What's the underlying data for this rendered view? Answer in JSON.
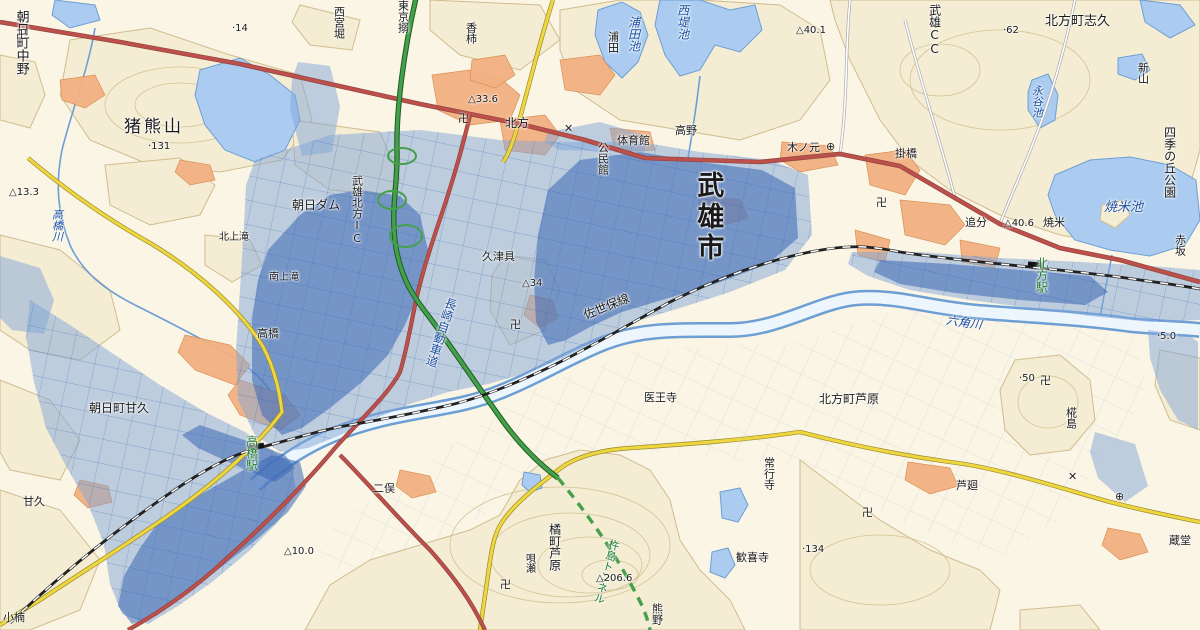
{
  "map": {
    "colors": {
      "base": "#faf5e4",
      "hill": "#f4edd3",
      "contour": "#d2bc8f",
      "water": "#abccf0",
      "water_edge": "#6d9fd4",
      "river_fill": "#eef6fd",
      "flood_light": "rgba(128,165,216,0.50)",
      "flood_dark": "rgba(58,104,180,0.55)",
      "flood_grid": "#2f62b5",
      "field_grid": "#c3cfdf",
      "road_red": "#bd504a",
      "road_red_edge": "#8f4440",
      "road_yellow": "#eed63e",
      "road_yellow_edge": "#9a8a30",
      "expressway": "#44a04a",
      "expressway_edge": "#1f5c24",
      "railway": "#222222",
      "builtup": "#f2b183",
      "builtup_edge": "#d98c4f",
      "label_black": "#1a1a1a",
      "label_water": "#1c4fa0",
      "label_station": "#1f7a33"
    },
    "labels": [
      {
        "text": "朝日町中野",
        "x": 14,
        "y": 10,
        "dir": "v",
        "size": 13,
        "color": "black"
      },
      {
        "text": "猪熊山",
        "x": 124,
        "y": 119,
        "dir": "h",
        "size": 17,
        "color": "black",
        "spacing": 3
      },
      {
        "text": "·131",
        "x": 148,
        "y": 142,
        "dir": "h",
        "size": 10,
        "color": "black"
      },
      {
        "text": "·14",
        "x": 232,
        "y": 24,
        "dir": "h",
        "size": 10,
        "color": "black"
      },
      {
        "text": "西宮堀",
        "x": 333,
        "y": 6,
        "dir": "v",
        "size": 11,
        "color": "black"
      },
      {
        "text": "東京搦",
        "x": 397,
        "y": 0,
        "dir": "v",
        "size": 11,
        "color": "black"
      },
      {
        "text": "香柿",
        "x": 465,
        "y": 22,
        "dir": "v",
        "size": 11,
        "color": "black"
      },
      {
        "text": "浦田",
        "x": 607,
        "y": 31,
        "dir": "v",
        "size": 11,
        "color": "black"
      },
      {
        "text": "浦田池",
        "x": 627,
        "y": 16,
        "dir": "v",
        "size": 12,
        "color": "water",
        "italic": true
      },
      {
        "text": "西堤池",
        "x": 676,
        "y": 4,
        "dir": "v",
        "size": 12,
        "color": "water",
        "italic": true
      },
      {
        "text": "武雄CC",
        "x": 928,
        "y": 4,
        "dir": "v",
        "size": 12,
        "color": "black"
      },
      {
        "text": "△40.1",
        "x": 796,
        "y": 26,
        "dir": "h",
        "size": 10,
        "color": "black"
      },
      {
        "text": "·62",
        "x": 1003,
        "y": 26,
        "dir": "h",
        "size": 10,
        "color": "black"
      },
      {
        "text": "北方町志久",
        "x": 1045,
        "y": 15,
        "dir": "h",
        "size": 13,
        "color": "black"
      },
      {
        "text": "新山",
        "x": 1137,
        "y": 62,
        "dir": "v",
        "size": 11,
        "color": "black"
      },
      {
        "text": "永谷池",
        "x": 1031,
        "y": 85,
        "dir": "v",
        "size": 11,
        "color": "water",
        "italic": true
      },
      {
        "text": "四季の丘公園",
        "x": 1163,
        "y": 126,
        "dir": "v",
        "size": 12,
        "color": "black"
      },
      {
        "text": "焼米池",
        "x": 1104,
        "y": 201,
        "dir": "h",
        "size": 13,
        "color": "water",
        "italic": true
      },
      {
        "text": "焼米",
        "x": 1043,
        "y": 217,
        "dir": "h",
        "size": 11,
        "color": "black"
      },
      {
        "text": "△40.6",
        "x": 1004,
        "y": 219,
        "dir": "h",
        "size": 10,
        "color": "black"
      },
      {
        "text": "追分",
        "x": 965,
        "y": 217,
        "dir": "h",
        "size": 11,
        "color": "black"
      },
      {
        "text": "掛橋",
        "x": 895,
        "y": 148,
        "dir": "h",
        "size": 11,
        "color": "black"
      },
      {
        "text": "赤坂",
        "x": 1174,
        "y": 234,
        "dir": "v",
        "size": 11,
        "color": "black"
      },
      {
        "text": "体育館",
        "x": 617,
        "y": 135,
        "dir": "h",
        "size": 11,
        "color": "black"
      },
      {
        "text": "公民館",
        "x": 597,
        "y": 142,
        "dir": "v",
        "size": 11,
        "color": "black"
      },
      {
        "text": "高野",
        "x": 675,
        "y": 125,
        "dir": "h",
        "size": 11,
        "color": "black"
      },
      {
        "text": "木ノ元",
        "x": 787,
        "y": 142,
        "dir": "h",
        "size": 11,
        "color": "black"
      },
      {
        "text": "北方",
        "x": 505,
        "y": 117,
        "dir": "h",
        "size": 12,
        "color": "black"
      },
      {
        "text": "△33.6",
        "x": 468,
        "y": 95,
        "dir": "h",
        "size": 10,
        "color": "black"
      },
      {
        "text": "武雄市",
        "x": 693,
        "y": 171,
        "dir": "v",
        "size": 27,
        "color": "black",
        "bold": true,
        "spacing": 4
      },
      {
        "text": "朝日ダム",
        "x": 292,
        "y": 199,
        "dir": "h",
        "size": 12,
        "color": "black"
      },
      {
        "text": "武雄北方IC",
        "x": 351,
        "y": 175,
        "dir": "v",
        "size": 11,
        "color": "black"
      },
      {
        "text": "高橋川",
        "x": 51,
        "y": 209,
        "dir": "v",
        "size": 11,
        "color": "water",
        "italic": true
      },
      {
        "text": "△13.3",
        "x": 9,
        "y": 188,
        "dir": "h",
        "size": 10,
        "color": "black"
      },
      {
        "text": "北上滝",
        "x": 219,
        "y": 233,
        "dir": "h",
        "size": 10,
        "color": "black"
      },
      {
        "text": "南上滝",
        "x": 269,
        "y": 273,
        "dir": "h",
        "size": 10,
        "color": "black"
      },
      {
        "text": "久津具",
        "x": 482,
        "y": 251,
        "dir": "h",
        "size": 11,
        "color": "black"
      },
      {
        "text": "△34",
        "x": 522,
        "y": 279,
        "dir": "h",
        "size": 10,
        "color": "black"
      },
      {
        "text": "長崎自動車道",
        "x": 446,
        "y": 296,
        "dir": "v",
        "size": 12,
        "color": "water",
        "rotate": 18
      },
      {
        "text": "佐世保線",
        "x": 582,
        "y": 310,
        "dir": "h",
        "size": 12,
        "color": "black",
        "rotate": -22
      },
      {
        "text": "六角川",
        "x": 947,
        "y": 314,
        "dir": "h",
        "size": 12,
        "color": "water",
        "italic": true,
        "rotate": 8
      },
      {
        "text": "北方駅",
        "x": 1035,
        "y": 257,
        "dir": "v",
        "size": 12,
        "color": "station"
      },
      {
        "text": "·50",
        "x": 1019,
        "y": 374,
        "dir": "h",
        "size": 10,
        "color": "black"
      },
      {
        "text": "·5.0",
        "x": 1157,
        "y": 332,
        "dir": "h",
        "size": 10,
        "color": "black"
      },
      {
        "text": "北方町芦原",
        "x": 819,
        "y": 393,
        "dir": "h",
        "size": 12,
        "color": "black"
      },
      {
        "text": "椛島",
        "x": 1065,
        "y": 407,
        "dir": "v",
        "size": 11,
        "color": "black"
      },
      {
        "text": "医王寺",
        "x": 644,
        "y": 392,
        "dir": "h",
        "size": 11,
        "color": "black"
      },
      {
        "text": "朝日町甘久",
        "x": 89,
        "y": 402,
        "dir": "h",
        "size": 12,
        "color": "black"
      },
      {
        "text": "甘久",
        "x": 23,
        "y": 496,
        "dir": "h",
        "size": 11,
        "color": "black"
      },
      {
        "text": "高橋",
        "x": 257,
        "y": 328,
        "dir": "h",
        "size": 11,
        "color": "black"
      },
      {
        "text": "高橋駅",
        "x": 245,
        "y": 435,
        "dir": "v",
        "size": 12,
        "color": "station"
      },
      {
        "text": "二俣",
        "x": 373,
        "y": 483,
        "dir": "h",
        "size": 11,
        "color": "black"
      },
      {
        "text": "△10.0",
        "x": 284,
        "y": 547,
        "dir": "h",
        "size": 10,
        "color": "black"
      },
      {
        "text": "常行寺",
        "x": 763,
        "y": 457,
        "dir": "v",
        "size": 11,
        "color": "black"
      },
      {
        "text": "歓喜寺",
        "x": 736,
        "y": 552,
        "dir": "h",
        "size": 11,
        "color": "black"
      },
      {
        "text": "唄瀬",
        "x": 523,
        "y": 553,
        "dir": "v",
        "size": 10,
        "color": "black"
      },
      {
        "text": "橘町芦原",
        "x": 548,
        "y": 523,
        "dir": "v",
        "size": 12,
        "color": "black"
      },
      {
        "text": "杵島トンネル",
        "x": 609,
        "y": 538,
        "dir": "v",
        "size": 11,
        "color": "station",
        "rotate": 15
      },
      {
        "text": "△206.6",
        "x": 596,
        "y": 574,
        "dir": "h",
        "size": 10,
        "color": "black"
      },
      {
        "text": "熊野",
        "x": 651,
        "y": 603,
        "dir": "v",
        "size": 11,
        "color": "black"
      },
      {
        "text": "小楠",
        "x": 3,
        "y": 612,
        "dir": "h",
        "size": 11,
        "color": "black"
      },
      {
        "text": "蔵堂",
        "x": 1169,
        "y": 535,
        "dir": "h",
        "size": 11,
        "color": "black"
      },
      {
        "text": "·134",
        "x": 802,
        "y": 545,
        "dir": "h",
        "size": 10,
        "color": "black"
      },
      {
        "text": "芦廻",
        "x": 956,
        "y": 480,
        "dir": "h",
        "size": 11,
        "color": "black"
      }
    ],
    "symbols": [
      {
        "glyph": "卍",
        "name": "temple-icon",
        "x": 16,
        "y": 26
      },
      {
        "glyph": "卍",
        "name": "temple-icon",
        "x": 458,
        "y": 110
      },
      {
        "glyph": "卍",
        "name": "temple-icon",
        "x": 510,
        "y": 316
      },
      {
        "glyph": "卍",
        "name": "temple-icon",
        "x": 876,
        "y": 194
      },
      {
        "glyph": "卍",
        "name": "temple-icon",
        "x": 1040,
        "y": 372
      },
      {
        "glyph": "卍",
        "name": "temple-icon",
        "x": 862,
        "y": 504
      },
      {
        "glyph": "卍",
        "name": "temple-icon",
        "x": 500,
        "y": 576
      },
      {
        "glyph": "✕",
        "name": "police-box-icon",
        "x": 564,
        "y": 122
      },
      {
        "glyph": "✕",
        "name": "police-box-icon",
        "x": 1068,
        "y": 470
      },
      {
        "glyph": "⊕",
        "name": "town-office-icon",
        "x": 826,
        "y": 140
      },
      {
        "glyph": "⊕",
        "name": "town-office-icon",
        "x": 1115,
        "y": 490
      }
    ]
  }
}
